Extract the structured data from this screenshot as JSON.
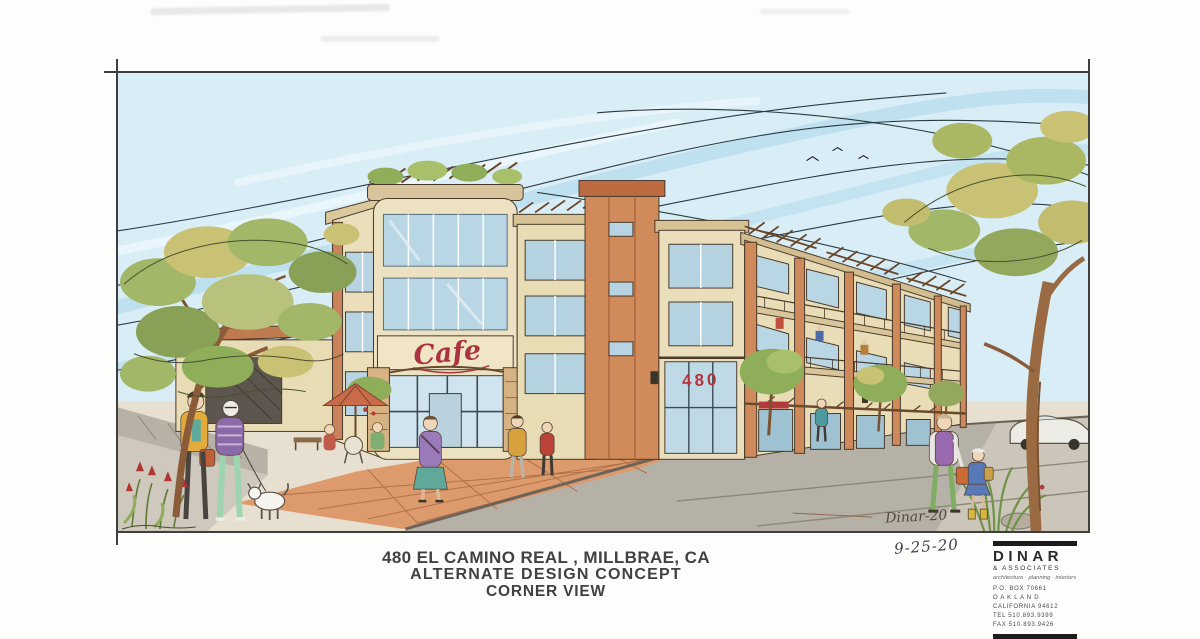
{
  "title_block": {
    "line1": "480 EL CAMINO REAL , MILLBRAE, CA",
    "line2": "ALTERNATE  DESIGN  CONCEPT",
    "line3": "CORNER VIEW"
  },
  "annotations": {
    "date": "9-25-20",
    "signature": "Dinar-20"
  },
  "building_signs": {
    "cafe": "Cafe",
    "address_number": "480"
  },
  "firm_block": {
    "name": "DINAR",
    "suffix": "& ASSOCIATES",
    "tagline": "architecture · planning · interiors",
    "address": [
      "P.O. BOX 70661",
      "O A K L A N D",
      "CALIFORNIA 94612",
      "TEL 510.893.9399",
      "FAX 510.893.9426"
    ]
  },
  "palette": {
    "sky": "#d8edf6",
    "sky_streak": "#b5dcec",
    "ink": "#4a3b2c",
    "wall_cream": "#e8ddb6",
    "tower_terracotta": "#d18a59",
    "glass_blue": "#b9d6e4",
    "paving_terracotta": "#dd9a6c",
    "asphalt": "#b6b1a7",
    "foliage_green": "#a3b768",
    "foliage_yellow": "#c9c274",
    "accent_red": "#ab3340"
  }
}
